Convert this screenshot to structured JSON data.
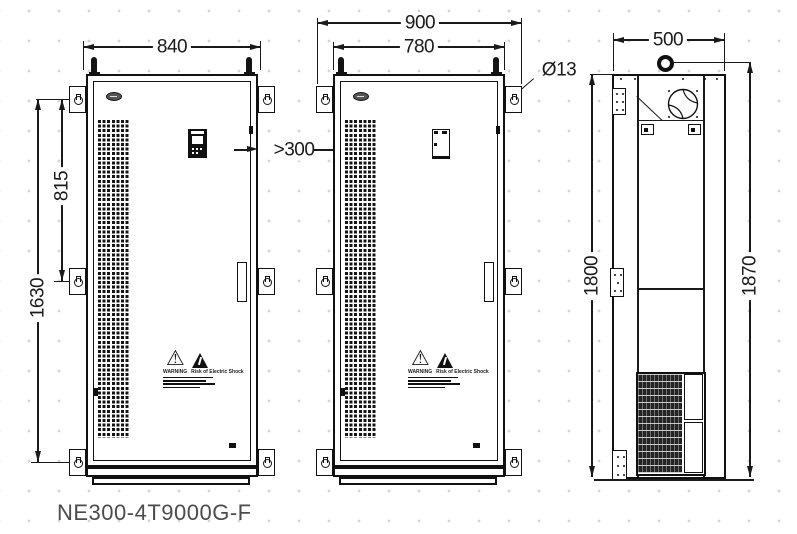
{
  "model_label": "NE300-4T9000G-F",
  "dimensions": {
    "front_left_width": "840",
    "front_mid_outer_width": "900",
    "front_mid_inner_width": "780",
    "side_depth": "500",
    "bracket_span_upper": "815",
    "bracket_span_full": "1630",
    "side_height": "1800",
    "side_total_height": "1870",
    "mounting_hole_dia": "Ø13",
    "min_clearance": ">300"
  },
  "warning": {
    "left_caption": "WARNING",
    "right_caption": "Risk of Electric Shock"
  },
  "colors": {
    "line": "#1a1a1a",
    "label_text": "#4b4b4b",
    "grid_dot": "#d6d6d6"
  }
}
